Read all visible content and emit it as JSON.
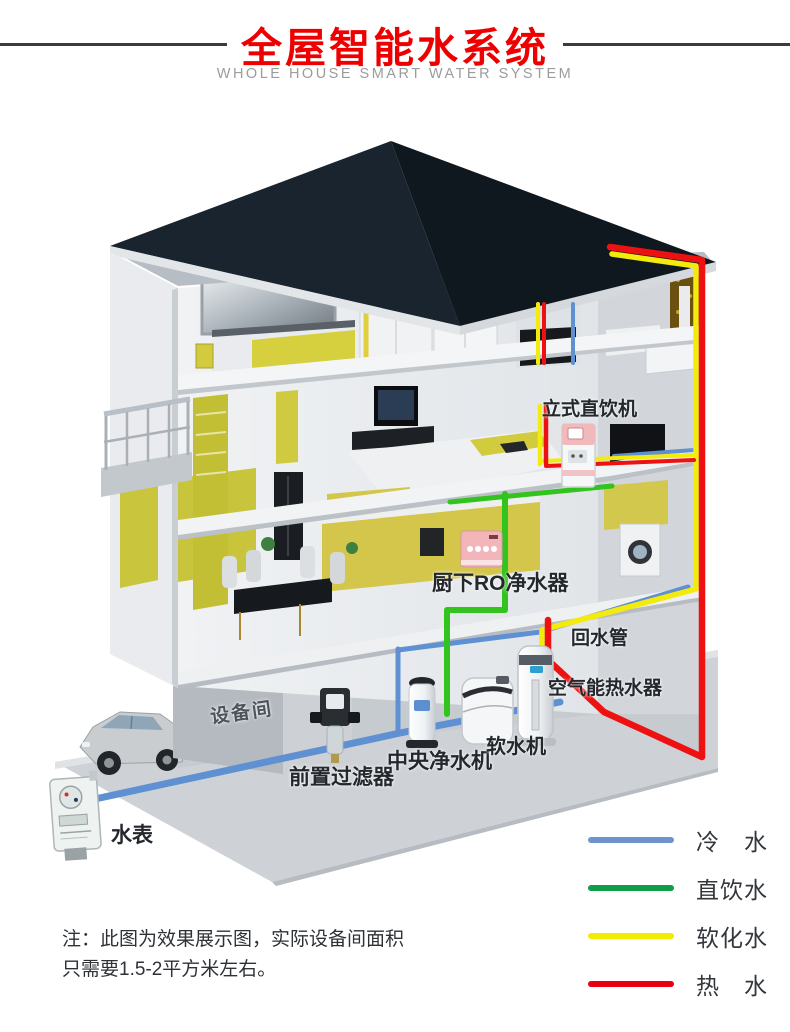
{
  "header": {
    "title": "全屋智能水系统",
    "subtitle": "WHOLE HOUSE SMART WATER SYSTEM"
  },
  "diagram": {
    "labels": {
      "standing_dispenser": "立式直饮机",
      "undersink_ro": "厨下RO净水器",
      "return_pipe": "回水管",
      "air_heater": "空气能热水器",
      "equipment_room": "设备间",
      "pre_filter": "前置过滤器",
      "central_purifier": "中央净水机",
      "softener": "软水机",
      "water_meter": "水表"
    },
    "icons": {
      "house": "house-cutaway-illustration",
      "car": "car-icon",
      "meter": "water-meter-icon"
    }
  },
  "legend": {
    "items": [
      {
        "label": "冷　水",
        "color": "#6f94cd"
      },
      {
        "label": "直饮水",
        "color": "#0e9d49"
      },
      {
        "label": "软化水",
        "color": "#f3eb00"
      },
      {
        "label": "热　水",
        "color": "#e60012"
      }
    ]
  },
  "note": {
    "line1": "注：此图为效果展示图，实际设备间面积",
    "line2": "只需要1.5-2平方米左右。"
  },
  "colors": {
    "title_red": "#ee0000",
    "rule_dark": "#3b3b3b",
    "roof_dark": "#141d27",
    "pipe_cold": "#5e90d2",
    "pipe_drinking": "#33c31e",
    "pipe_softened": "#f3eb0c",
    "pipe_hot": "#ee1111",
    "accent_yellow": "#c9c53c"
  }
}
